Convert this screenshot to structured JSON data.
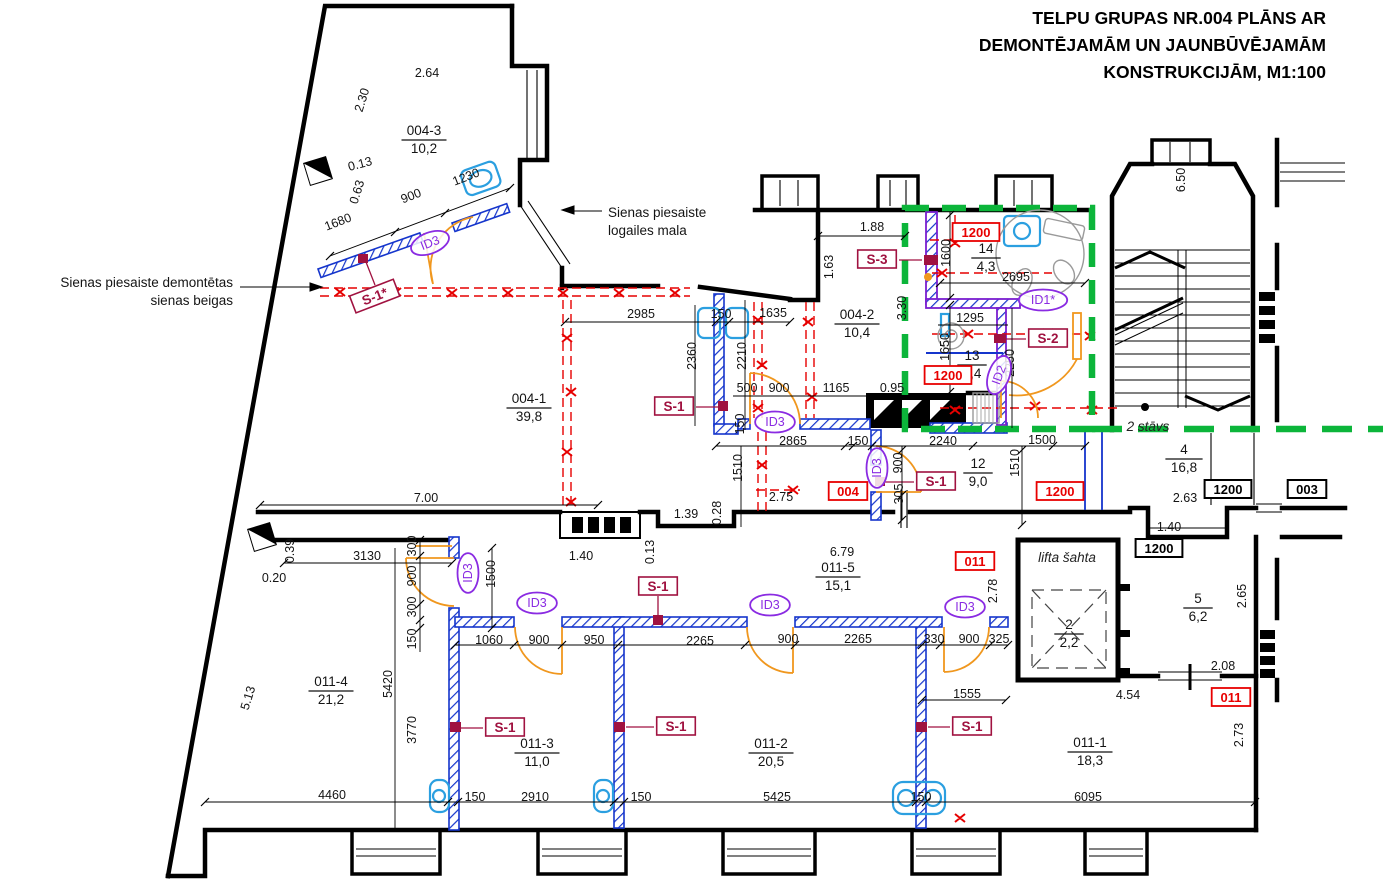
{
  "title": {
    "line1": "TELPU GRUPAS NR.004 PLĀNS AR",
    "line2": "DEMONTĒJAMĀM UN JAUNBŪVĒJAMĀM",
    "line3": "KONSTRUKCIJĀM, M1:100"
  },
  "colors": {
    "new_wall_blue": "#1535cc",
    "new_wall_purple": "#7a1fd0",
    "demolition_red": "#e60000",
    "section_green": "#0cb53a",
    "door_orange": "#f0971e",
    "fixture_cyan": "#2b9fe0",
    "marker_dark_red": "#a01240",
    "id_purple": "#8a2be2"
  },
  "labels": [
    {
      "t": "2.64",
      "x": 427,
      "y": 73,
      "k": "dim"
    },
    {
      "t": "1.88",
      "x": 872,
      "y": 227,
      "k": "dim"
    },
    {
      "t": "2985",
      "x": 641,
      "y": 314,
      "k": "dim"
    },
    {
      "t": "150",
      "x": 721,
      "y": 314,
      "k": "dim"
    },
    {
      "t": "1635",
      "x": 773,
      "y": 313,
      "k": "dim"
    },
    {
      "t": "500",
      "x": 747,
      "y": 388,
      "k": "dim"
    },
    {
      "t": "900",
      "x": 779,
      "y": 388,
      "k": "dim"
    },
    {
      "t": "1165",
      "x": 836,
      "y": 388,
      "k": "dim"
    },
    {
      "t": "0.95",
      "x": 892,
      "y": 388,
      "k": "dim"
    },
    {
      "t": "2695",
      "x": 1016,
      "y": 277,
      "k": "dim"
    },
    {
      "t": "1295",
      "x": 970,
      "y": 318,
      "k": "dim"
    },
    {
      "t": "2240",
      "x": 943,
      "y": 441,
      "k": "dim"
    },
    {
      "t": "150",
      "x": 858,
      "y": 441,
      "k": "dim"
    },
    {
      "t": "1500",
      "x": 1042,
      "y": 440,
      "k": "dim"
    },
    {
      "t": "2865",
      "x": 793,
      "y": 441,
      "k": "dim"
    },
    {
      "t": "2.75",
      "x": 781,
      "y": 497,
      "k": "dim"
    },
    {
      "t": "1.39",
      "x": 686,
      "y": 514,
      "k": "dim"
    },
    {
      "t": "7.00",
      "x": 426,
      "y": 498,
      "k": "dim"
    },
    {
      "t": "3130",
      "x": 367,
      "y": 556,
      "k": "dim"
    },
    {
      "t": "0.20",
      "x": 274,
      "y": 578,
      "k": "dim"
    },
    {
      "t": "1.40",
      "x": 581,
      "y": 556,
      "k": "dim"
    },
    {
      "t": "6.79",
      "x": 842,
      "y": 552,
      "k": "dim"
    },
    {
      "t": "2265",
      "x": 858,
      "y": 639,
      "k": "dim"
    },
    {
      "t": "330",
      "x": 934,
      "y": 639,
      "k": "dim"
    },
    {
      "t": "900",
      "x": 969,
      "y": 639,
      "k": "dim"
    },
    {
      "t": "325",
      "x": 999,
      "y": 639,
      "k": "dim"
    },
    {
      "t": "1060",
      "x": 489,
      "y": 640,
      "k": "dim"
    },
    {
      "t": "900",
      "x": 539,
      "y": 640,
      "k": "dim"
    },
    {
      "t": "950",
      "x": 594,
      "y": 640,
      "k": "dim"
    },
    {
      "t": "2265",
      "x": 700,
      "y": 641,
      "k": "dim"
    },
    {
      "t": "900",
      "x": 788,
      "y": 639,
      "k": "dim"
    },
    {
      "t": "2.63",
      "x": 1185,
      "y": 498,
      "k": "dim"
    },
    {
      "t": "1.40",
      "x": 1169,
      "y": 527,
      "k": "dim"
    },
    {
      "t": "2.08",
      "x": 1223,
      "y": 666,
      "k": "dim"
    },
    {
      "t": "4.54",
      "x": 1128,
      "y": 695,
      "k": "dim"
    },
    {
      "t": "1555",
      "x": 967,
      "y": 694,
      "k": "dim"
    },
    {
      "t": "4460",
      "x": 332,
      "y": 795,
      "k": "dim"
    },
    {
      "t": "150",
      "x": 475,
      "y": 797,
      "k": "dim"
    },
    {
      "t": "2910",
      "x": 535,
      "y": 797,
      "k": "dim"
    },
    {
      "t": "150",
      "x": 641,
      "y": 797,
      "k": "dim"
    },
    {
      "t": "5425",
      "x": 777,
      "y": 797,
      "k": "dim"
    },
    {
      "t": "150",
      "x": 921,
      "y": 797,
      "k": "dim"
    },
    {
      "t": "6095",
      "x": 1088,
      "y": 797,
      "k": "dim"
    },
    {
      "t": "1.63",
      "x": 829,
      "y": 267,
      "k": "dim",
      "r": -90
    },
    {
      "t": "3.30",
      "x": 902,
      "y": 308,
      "k": "dim",
      "r": -90
    },
    {
      "t": "1600",
      "x": 946,
      "y": 253,
      "k": "dim",
      "r": -90
    },
    {
      "t": "1650",
      "x": 945,
      "y": 347,
      "k": "dim",
      "r": -90
    },
    {
      "t": "2250",
      "x": 1010,
      "y": 363,
      "k": "dim",
      "r": -90
    },
    {
      "t": "2360",
      "x": 692,
      "y": 356,
      "k": "dim",
      "r": -90
    },
    {
      "t": "2210",
      "x": 742,
      "y": 356,
      "k": "dim",
      "r": -90
    },
    {
      "t": "150",
      "x": 740,
      "y": 424,
      "k": "dim",
      "r": -90
    },
    {
      "t": "6.50",
      "x": 1181,
      "y": 180,
      "k": "dim",
      "r": -90
    },
    {
      "t": "1510",
      "x": 1015,
      "y": 463,
      "k": "dim",
      "r": -90
    },
    {
      "t": "900",
      "x": 898,
      "y": 463,
      "k": "dim",
      "r": -90
    },
    {
      "t": "305",
      "x": 899,
      "y": 494,
      "k": "dim",
      "r": -90
    },
    {
      "t": "1510",
      "x": 738,
      "y": 468,
      "k": "dim",
      "r": -90
    },
    {
      "t": "0.28",
      "x": 717,
      "y": 513,
      "k": "dim",
      "r": -90
    },
    {
      "t": "0.39",
      "x": 290,
      "y": 551,
      "k": "dim",
      "r": -90
    },
    {
      "t": "300",
      "x": 412,
      "y": 546,
      "k": "dim",
      "r": -90
    },
    {
      "t": "900",
      "x": 412,
      "y": 576,
      "k": "dim",
      "r": -90
    },
    {
      "t": "300",
      "x": 412,
      "y": 607,
      "k": "dim",
      "r": -90
    },
    {
      "t": "150",
      "x": 412,
      "y": 639,
      "k": "dim",
      "r": -90
    },
    {
      "t": "1500",
      "x": 491,
      "y": 574,
      "k": "dim",
      "r": -90
    },
    {
      "t": "5420",
      "x": 388,
      "y": 684,
      "k": "dim",
      "r": -90
    },
    {
      "t": "3770",
      "x": 412,
      "y": 730,
      "k": "dim",
      "r": -90
    },
    {
      "t": "0.13",
      "x": 650,
      "y": 552,
      "k": "dim",
      "r": -90
    },
    {
      "t": "2.78",
      "x": 993,
      "y": 591,
      "k": "dim",
      "r": -90
    },
    {
      "t": "2.65",
      "x": 1242,
      "y": 596,
      "k": "dim",
      "r": -90
    },
    {
      "t": "2.73",
      "x": 1239,
      "y": 735,
      "k": "dim",
      "r": -90
    },
    {
      "t": "2.30",
      "x": 362,
      "y": 100,
      "k": "dim",
      "r": -73
    },
    {
      "t": "0.63",
      "x": 357,
      "y": 192,
      "k": "dim",
      "r": -73
    },
    {
      "t": "5.13",
      "x": 248,
      "y": 698,
      "k": "dim",
      "r": -73
    },
    {
      "t": "1680",
      "x": 338,
      "y": 222,
      "k": "dim",
      "r": -21
    },
    {
      "t": "900",
      "x": 411,
      "y": 196,
      "k": "dim",
      "r": -21
    },
    {
      "t": "1230",
      "x": 466,
      "y": 177,
      "k": "dim",
      "r": -21
    },
    {
      "t": "0.13",
      "x": 360,
      "y": 164,
      "k": "dim",
      "r": -15
    },
    {
      "t": "004-3",
      "b": "10,2",
      "x": 424,
      "y": 137,
      "k": "frac"
    },
    {
      "t": "004-2",
      "b": "10,4",
      "x": 857,
      "y": 321,
      "k": "frac"
    },
    {
      "t": "004-1",
      "b": "39,8",
      "x": 529,
      "y": 405,
      "k": "frac"
    },
    {
      "t": "14",
      "b": "4,3",
      "x": 986,
      "y": 255,
      "k": "frac"
    },
    {
      "t": "13",
      "b": "2,4",
      "x": 972,
      "y": 362,
      "k": "frac"
    },
    {
      "t": "12",
      "b": "9,0",
      "x": 978,
      "y": 470,
      "k": "frac"
    },
    {
      "t": "4",
      "b": "16,8",
      "x": 1184,
      "y": 456,
      "k": "frac"
    },
    {
      "t": "5",
      "b": "6,2",
      "x": 1198,
      "y": 605,
      "k": "frac"
    },
    {
      "t": "2",
      "b": "2,2",
      "x": 1069,
      "y": 631,
      "k": "frac"
    },
    {
      "t": "011-5",
      "b": "15,1",
      "x": 838,
      "y": 574,
      "k": "frac"
    },
    {
      "t": "011-4",
      "b": "21,2",
      "x": 331,
      "y": 688,
      "k": "frac"
    },
    {
      "t": "011-3",
      "b": "11,0",
      "x": 537,
      "y": 750,
      "k": "frac"
    },
    {
      "t": "011-2",
      "b": "20,5",
      "x": 771,
      "y": 750,
      "k": "frac"
    },
    {
      "t": "011-1",
      "b": "18,3",
      "x": 1090,
      "y": 749,
      "k": "frac"
    },
    {
      "t": "1200",
      "x": 976,
      "y": 233,
      "k": "redbox"
    },
    {
      "t": "1200",
      "x": 948,
      "y": 376,
      "k": "redbox"
    },
    {
      "t": "1200",
      "x": 1060,
      "y": 492,
      "k": "redbox"
    },
    {
      "t": "004",
      "x": 848,
      "y": 492,
      "k": "redbox"
    },
    {
      "t": "011",
      "x": 975,
      "y": 562,
      "k": "redbox"
    },
    {
      "t": "011",
      "x": 1231,
      "y": 698,
      "k": "redbox"
    },
    {
      "t": "1200",
      "x": 1228,
      "y": 490,
      "k": "blackbox"
    },
    {
      "t": "003",
      "x": 1307,
      "y": 490,
      "k": "blackbox"
    },
    {
      "t": "1200",
      "x": 1159,
      "y": 549,
      "k": "blackbox"
    },
    {
      "t": "S-1*",
      "x": 375,
      "y": 297,
      "k": "sbox",
      "r": -21
    },
    {
      "t": "S-1",
      "x": 674,
      "y": 407,
      "k": "sbox"
    },
    {
      "t": "S-1",
      "x": 936,
      "y": 482,
      "k": "sbox"
    },
    {
      "t": "S-3",
      "x": 877,
      "y": 260,
      "k": "sbox"
    },
    {
      "t": "S-2",
      "x": 1048,
      "y": 339,
      "k": "sbox"
    },
    {
      "t": "S-1",
      "x": 658,
      "y": 587,
      "k": "sbox"
    },
    {
      "t": "S-1",
      "x": 505,
      "y": 728,
      "k": "sbox"
    },
    {
      "t": "S-1",
      "x": 676,
      "y": 727,
      "k": "sbox"
    },
    {
      "t": "S-1",
      "x": 972,
      "y": 727,
      "k": "sbox"
    },
    {
      "t": "ID3",
      "x": 430,
      "y": 243,
      "k": "id",
      "r": -21
    },
    {
      "t": "ID3",
      "x": 775,
      "y": 422,
      "k": "id"
    },
    {
      "t": "ID3",
      "x": 877,
      "y": 468,
      "k": "id",
      "r": -90
    },
    {
      "t": "ID3",
      "x": 468,
      "y": 573,
      "k": "id",
      "r": -90
    },
    {
      "t": "ID3",
      "x": 537,
      "y": 603,
      "k": "id"
    },
    {
      "t": "ID3",
      "x": 770,
      "y": 605,
      "k": "id"
    },
    {
      "t": "ID3",
      "x": 965,
      "y": 607,
      "k": "id"
    },
    {
      "t": "ID1*",
      "x": 1043,
      "y": 300,
      "k": "id"
    },
    {
      "t": "ID2",
      "x": 999,
      "y": 375,
      "k": "id",
      "r": -70
    },
    {
      "t": "2 stāvs",
      "x": 1148,
      "y": 427,
      "k": "italic"
    },
    {
      "t": "lifta šahta",
      "x": 1067,
      "y": 558,
      "k": "italic"
    },
    {
      "t": "Sienas piesaiste demontētas",
      "x": 233,
      "y": 283,
      "k": "note",
      "a": "end"
    },
    {
      "t": "sienas beigas",
      "x": 233,
      "y": 301,
      "k": "note",
      "a": "end"
    },
    {
      "t": "Sienas piesaiste",
      "x": 608,
      "y": 213,
      "k": "note",
      "a": "start"
    },
    {
      "t": "logailes mala",
      "x": 608,
      "y": 231,
      "k": "note",
      "a": "start"
    }
  ]
}
